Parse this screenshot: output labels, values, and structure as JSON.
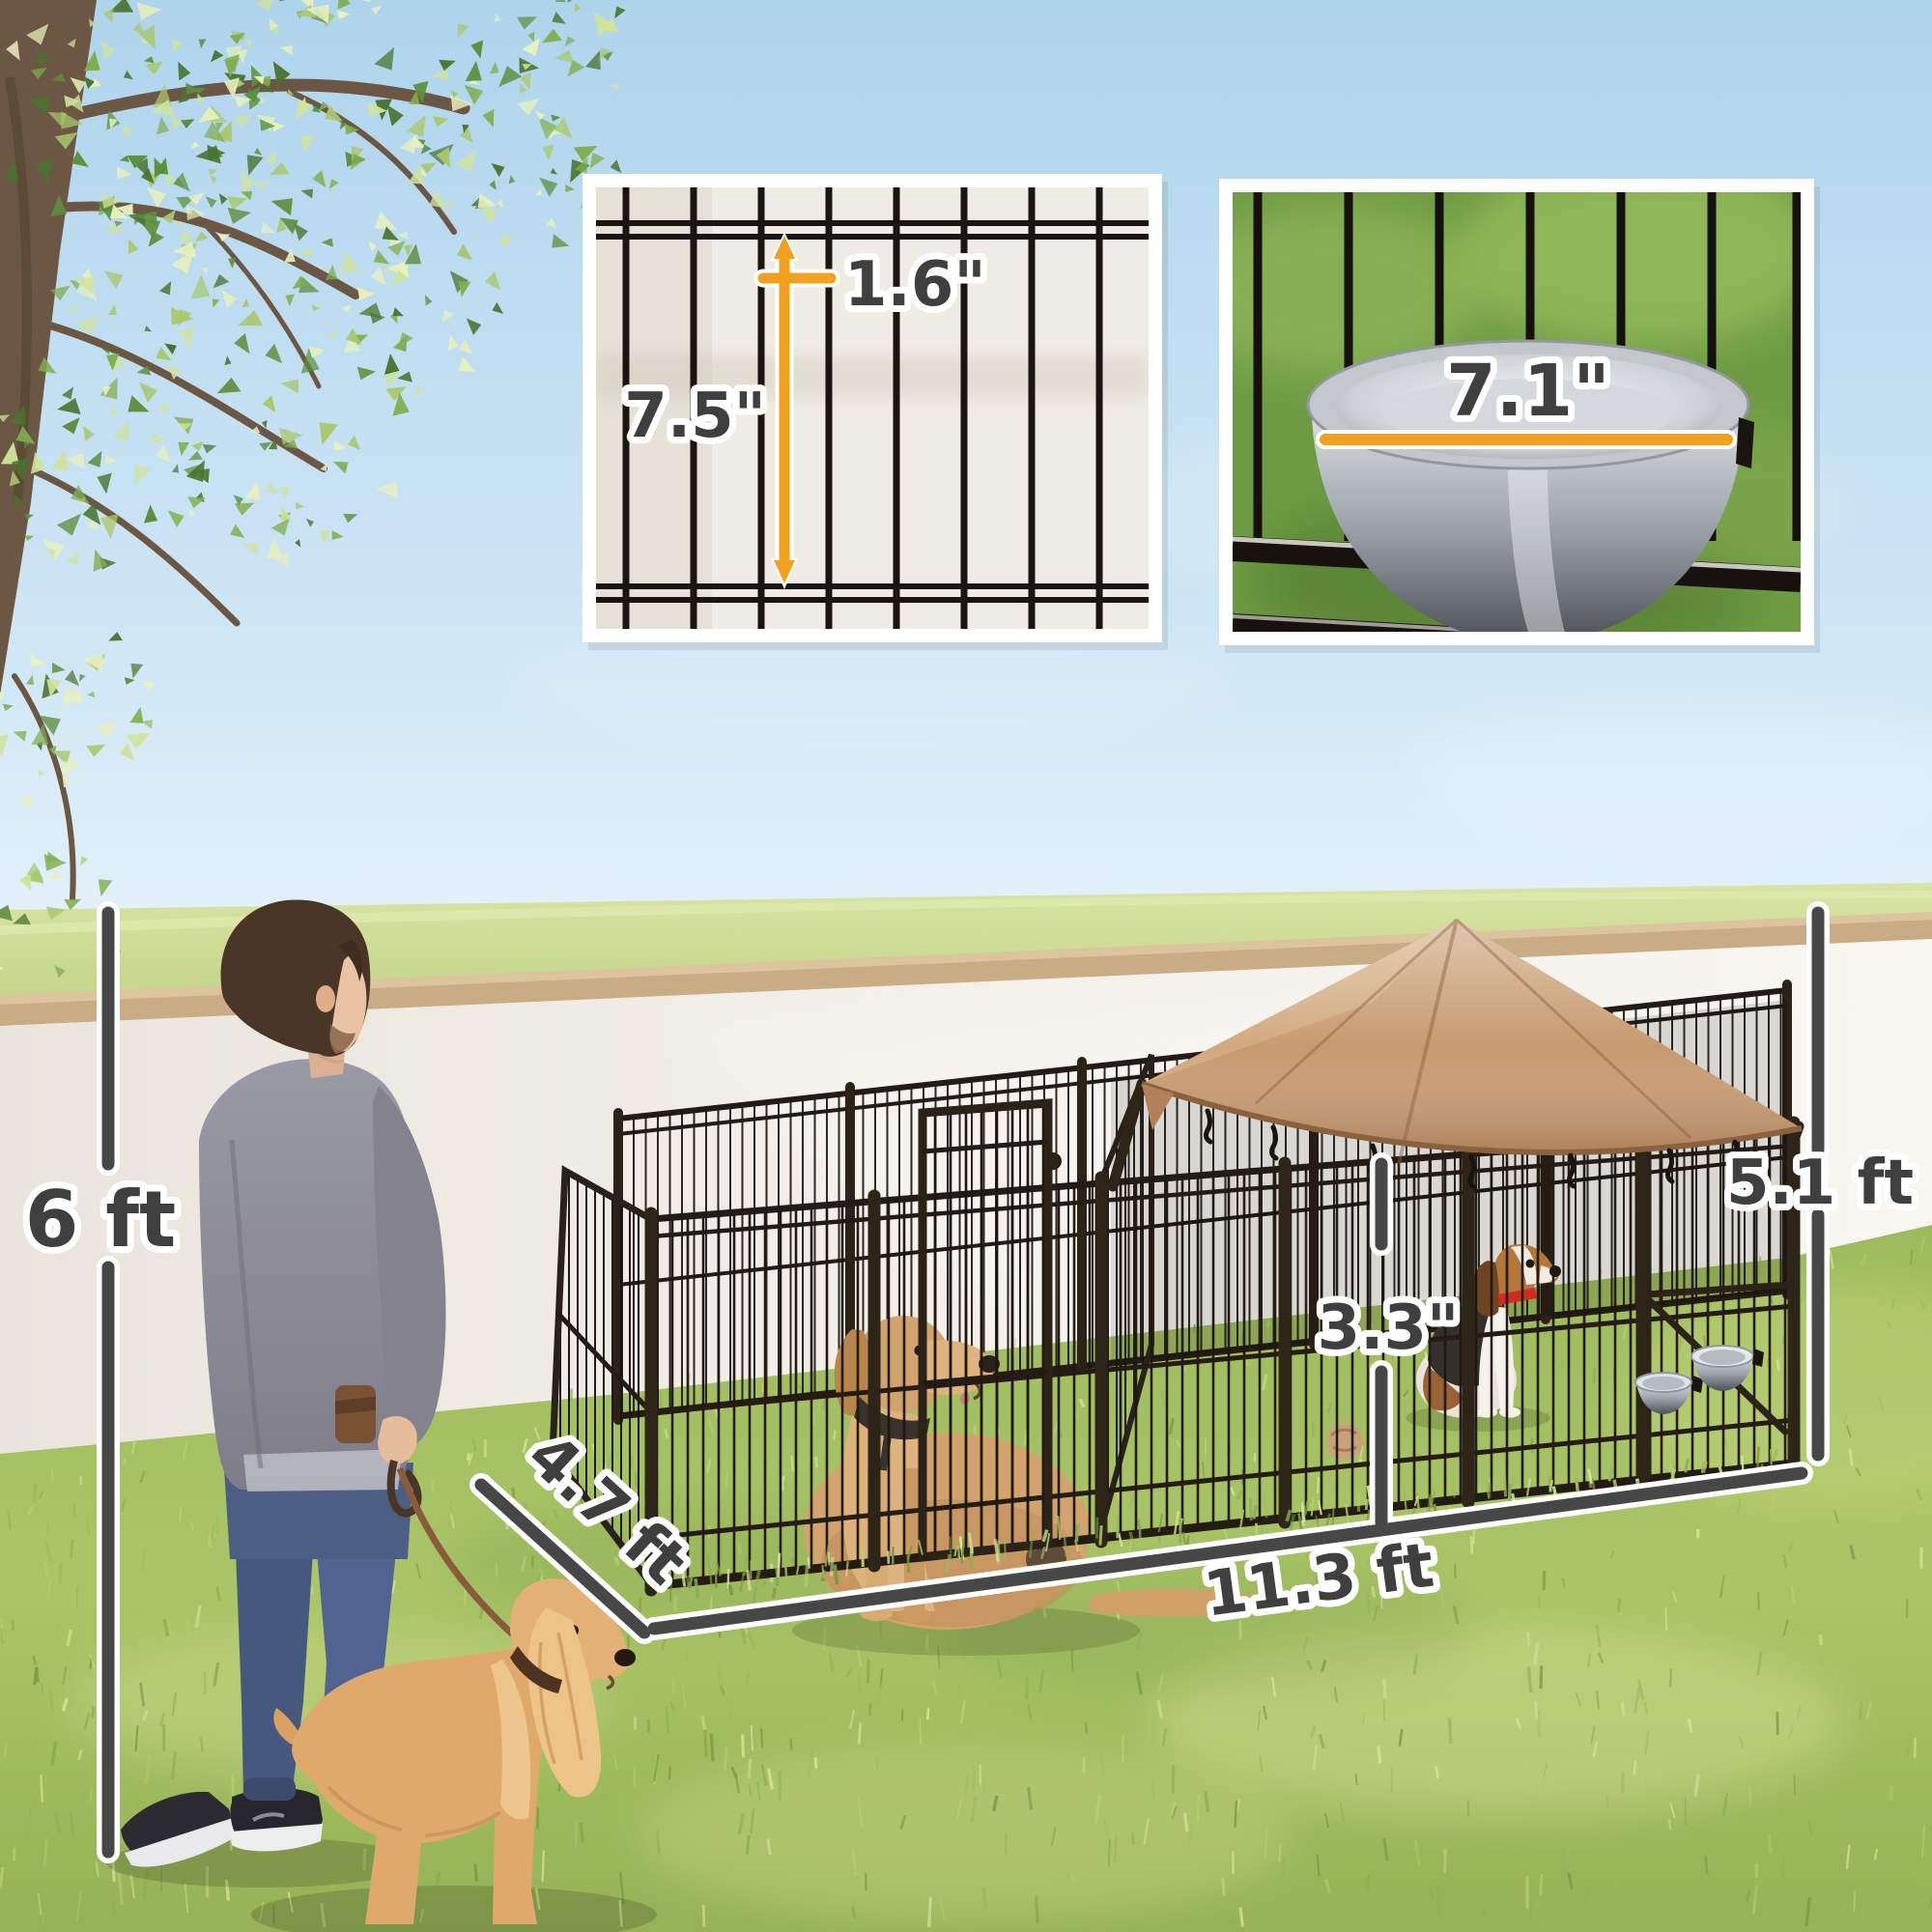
{
  "annotations": {
    "fence_height": "6 ft",
    "roof_height": "5.1 ft",
    "run_depth": "4.7 ft",
    "run_length": "11.3 ft",
    "wire_gap": "3.3\"",
    "inset_wire_height": "7.5\"",
    "inset_wire_spacing": "1.6\"",
    "inset_bowl_diameter": "7.1\""
  },
  "colors": {
    "accent_orange": "#f2a01d",
    "dimension_gray": "#474747",
    "canopy_tan": "#c79a6e",
    "kennel_metal": "#241c14",
    "sky_blue": "#b9dcf0",
    "grass_green": "#a5c364",
    "wall_white": "#f2f0ea"
  }
}
